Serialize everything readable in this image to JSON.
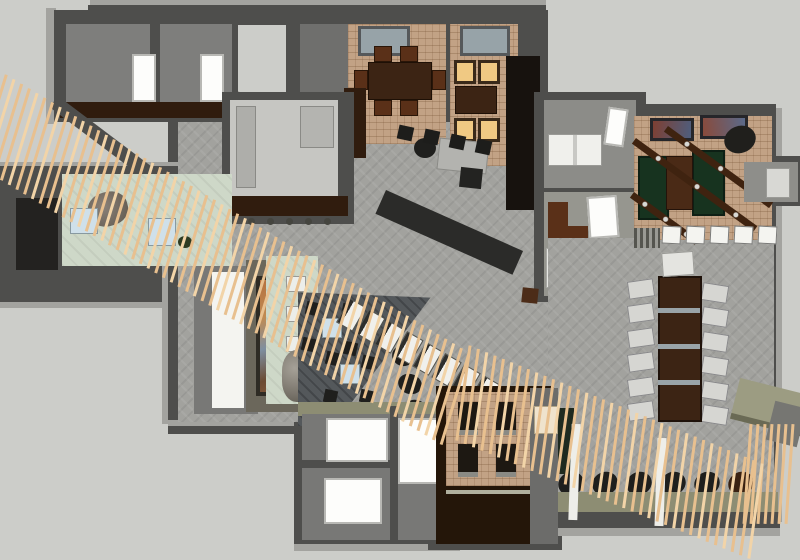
{
  "scene": {
    "kind": "3d-floorplan-render",
    "features": [
      "storage-rooms",
      "private-dining-room",
      "private-dining-room-lit",
      "kitchen",
      "entry-lounge",
      "art-wall",
      "lounge-seating",
      "wood-slat-ribbon",
      "game-room",
      "office-rooms",
      "communal-table",
      "booth-room",
      "restrooms",
      "barrel-row",
      "host-stand"
    ]
  },
  "palette": {
    "bg": "#cccdc9",
    "wall": "#4e4e4c",
    "wallTop": "#a3a39f",
    "wallLight": "#7e7e7c",
    "floor": "#a2a29e",
    "lounge": "#54585b",
    "brick": "#c2a285",
    "wood": "#3c2414",
    "woodDark": "#301c0e",
    "woodMid": "#5a3018",
    "slat": "#e8c08f",
    "slatLight": "#f2d4a8",
    "green": "#ced8c8",
    "gameGreen": "#17331f",
    "amber": "#f0c983",
    "white": "#f2f2ee",
    "blue": "#cfe0ea",
    "black": "#1f1f1d",
    "olive": "#8d8d73",
    "steel": "#9aa4a8",
    "skylight": "#97a3a8"
  },
  "repeats": {
    "ribbon_a_slats": 62,
    "ribbon_b_slats": 36,
    "wall_slats": 7,
    "communal_chairs_left": 6,
    "communal_chairs_right": 6,
    "barrels": 6,
    "office_stools": 3,
    "game_seats": 5,
    "diag_tables": 8,
    "bench_seats": 3,
    "kitchen_stools": 5
  }
}
